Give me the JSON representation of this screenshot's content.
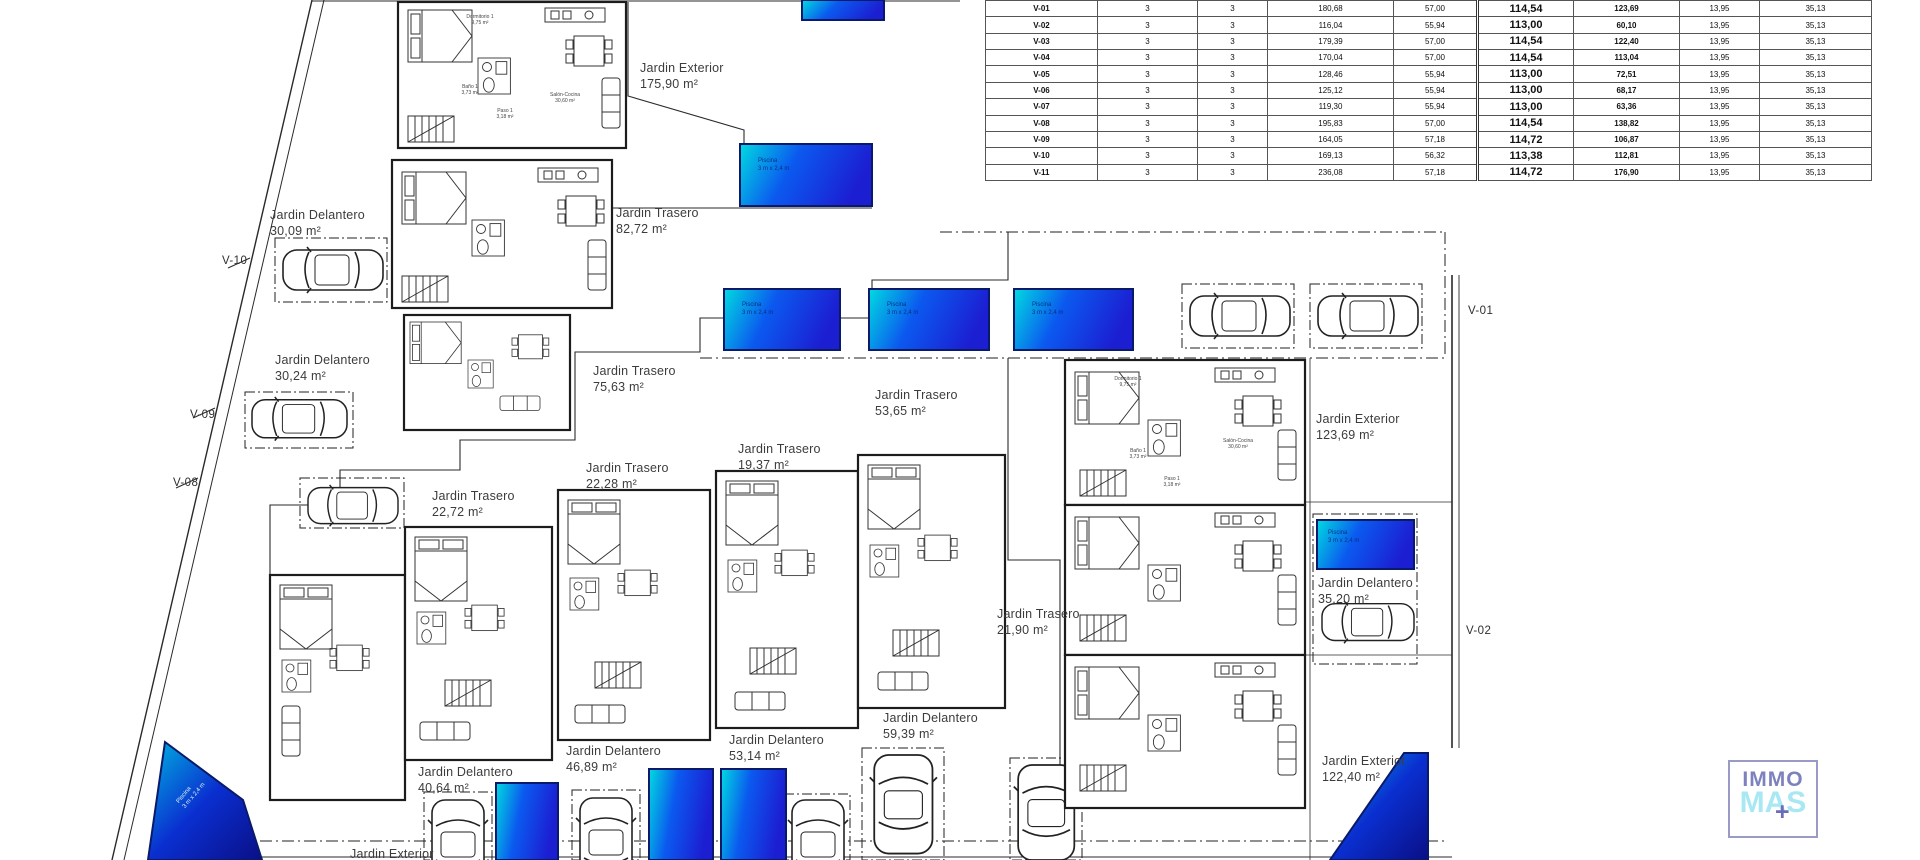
{
  "table": {
    "rows": [
      {
        "id": "V-01",
        "c2": "3",
        "c3": "3",
        "c4": "180,68",
        "c5": "57,00",
        "c6": "114,54",
        "c7": "123,69",
        "c8": "13,95",
        "c9": "35,13"
      },
      {
        "id": "V-02",
        "c2": "3",
        "c3": "3",
        "c4": "116,04",
        "c5": "55,94",
        "c6": "113,00",
        "c7": "60,10",
        "c8": "13,95",
        "c9": "35,13"
      },
      {
        "id": "V-03",
        "c2": "3",
        "c3": "3",
        "c4": "179,39",
        "c5": "57,00",
        "c6": "114,54",
        "c7": "122,40",
        "c8": "13,95",
        "c9": "35,13"
      },
      {
        "id": "V-04",
        "c2": "3",
        "c3": "3",
        "c4": "170,04",
        "c5": "57,00",
        "c6": "114,54",
        "c7": "113,04",
        "c8": "13,95",
        "c9": "35,13"
      },
      {
        "id": "V-05",
        "c2": "3",
        "c3": "3",
        "c4": "128,46",
        "c5": "55,94",
        "c6": "113,00",
        "c7": "72,51",
        "c8": "13,95",
        "c9": "35,13"
      },
      {
        "id": "V-06",
        "c2": "3",
        "c3": "3",
        "c4": "125,12",
        "c5": "55,94",
        "c6": "113,00",
        "c7": "68,17",
        "c8": "13,95",
        "c9": "35,13"
      },
      {
        "id": "V-07",
        "c2": "3",
        "c3": "3",
        "c4": "119,30",
        "c5": "55,94",
        "c6": "113,00",
        "c7": "63,36",
        "c8": "13,95",
        "c9": "35,13"
      },
      {
        "id": "V-08",
        "c2": "3",
        "c3": "3",
        "c4": "195,83",
        "c5": "57,00",
        "c6": "114,54",
        "c7": "138,82",
        "c8": "13,95",
        "c9": "35,13"
      },
      {
        "id": "V-09",
        "c2": "3",
        "c3": "3",
        "c4": "164,05",
        "c5": "57,18",
        "c6": "114,72",
        "c7": "106,87",
        "c8": "13,95",
        "c9": "35,13"
      },
      {
        "id": "V-10",
        "c2": "3",
        "c3": "3",
        "c4": "169,13",
        "c5": "56,32",
        "c6": "113,38",
        "c7": "112,81",
        "c8": "13,95",
        "c9": "35,13"
      },
      {
        "id": "V-11",
        "c2": "3",
        "c3": "3",
        "c4": "236,08",
        "c5": "57,18",
        "c6": "114,72",
        "c7": "176,90",
        "c8": "13,95",
        "c9": "35,13"
      }
    ]
  },
  "plan": {
    "garden_labels": [
      {
        "line1": "Jardin Exterior",
        "line2": "175,90 m²"
      },
      {
        "line1": "Jardin Trasero",
        "line2": "82,72 m²"
      },
      {
        "line1": "Jardin Delantero",
        "line2": "30,09 m²"
      },
      {
        "line1": "Jardin Delantero",
        "line2": "30,24 m²"
      },
      {
        "line1": "Jardin Trasero",
        "line2": "75,63 m²"
      },
      {
        "line1": "Jardin Trasero",
        "line2": "53,65 m²"
      },
      {
        "line1": "Jardin Trasero",
        "line2": "19,37 m²"
      },
      {
        "line1": "Jardin Trasero",
        "line2": "22,28 m²"
      },
      {
        "line1": "Jardin Trasero",
        "line2": "22,72 m²"
      },
      {
        "line1": "Jardin Exterior",
        "line2": "123,69 m²"
      },
      {
        "line1": "Jardin Delantero",
        "line2": "35,20 m²"
      },
      {
        "line1": "Jardin Trasero",
        "line2": "21,90 m²"
      },
      {
        "line1": "Jardin Exterior",
        "line2": "122,40 m²"
      },
      {
        "line1": "Jardin Delantero",
        "line2": "59,39 m²"
      },
      {
        "line1": "Jardin Delantero",
        "line2": "53,14 m²"
      },
      {
        "line1": "Jardin Delantero",
        "line2": "46,89 m²"
      },
      {
        "line1": "Jardin Delantero",
        "line2": "40,64 m²"
      },
      {
        "line1": "Jardin Exterior",
        "line2": ""
      }
    ],
    "plot_labels": {
      "v10": "V-10",
      "v09": "V-09",
      "v08": "V-08",
      "v01": "V-01",
      "v02": "V-02"
    },
    "pool_label": {
      "line1": "Piscina",
      "line2": "3 m x 2,4 m"
    },
    "rooms": {
      "dorm": "Dormitorio 1",
      "dorm_area": "9,75 m²",
      "bano": "Baño 1",
      "bano_area": "3,73 m²",
      "paso": "Paso 1",
      "paso_area": "3,18 m²",
      "salon": "Salón-Cocina",
      "salon_area": "30,60 m²"
    }
  },
  "logo": {
    "top": "IMMO",
    "bottom": "MAS",
    "plus": "+"
  },
  "colors": {
    "pool_light": "#00dbe0",
    "pool_mid": "#0b59ef",
    "pool_deep": "#1c1ed2",
    "logo_purple": "#7d81bd",
    "logo_cyan": "#a8e8f2"
  }
}
